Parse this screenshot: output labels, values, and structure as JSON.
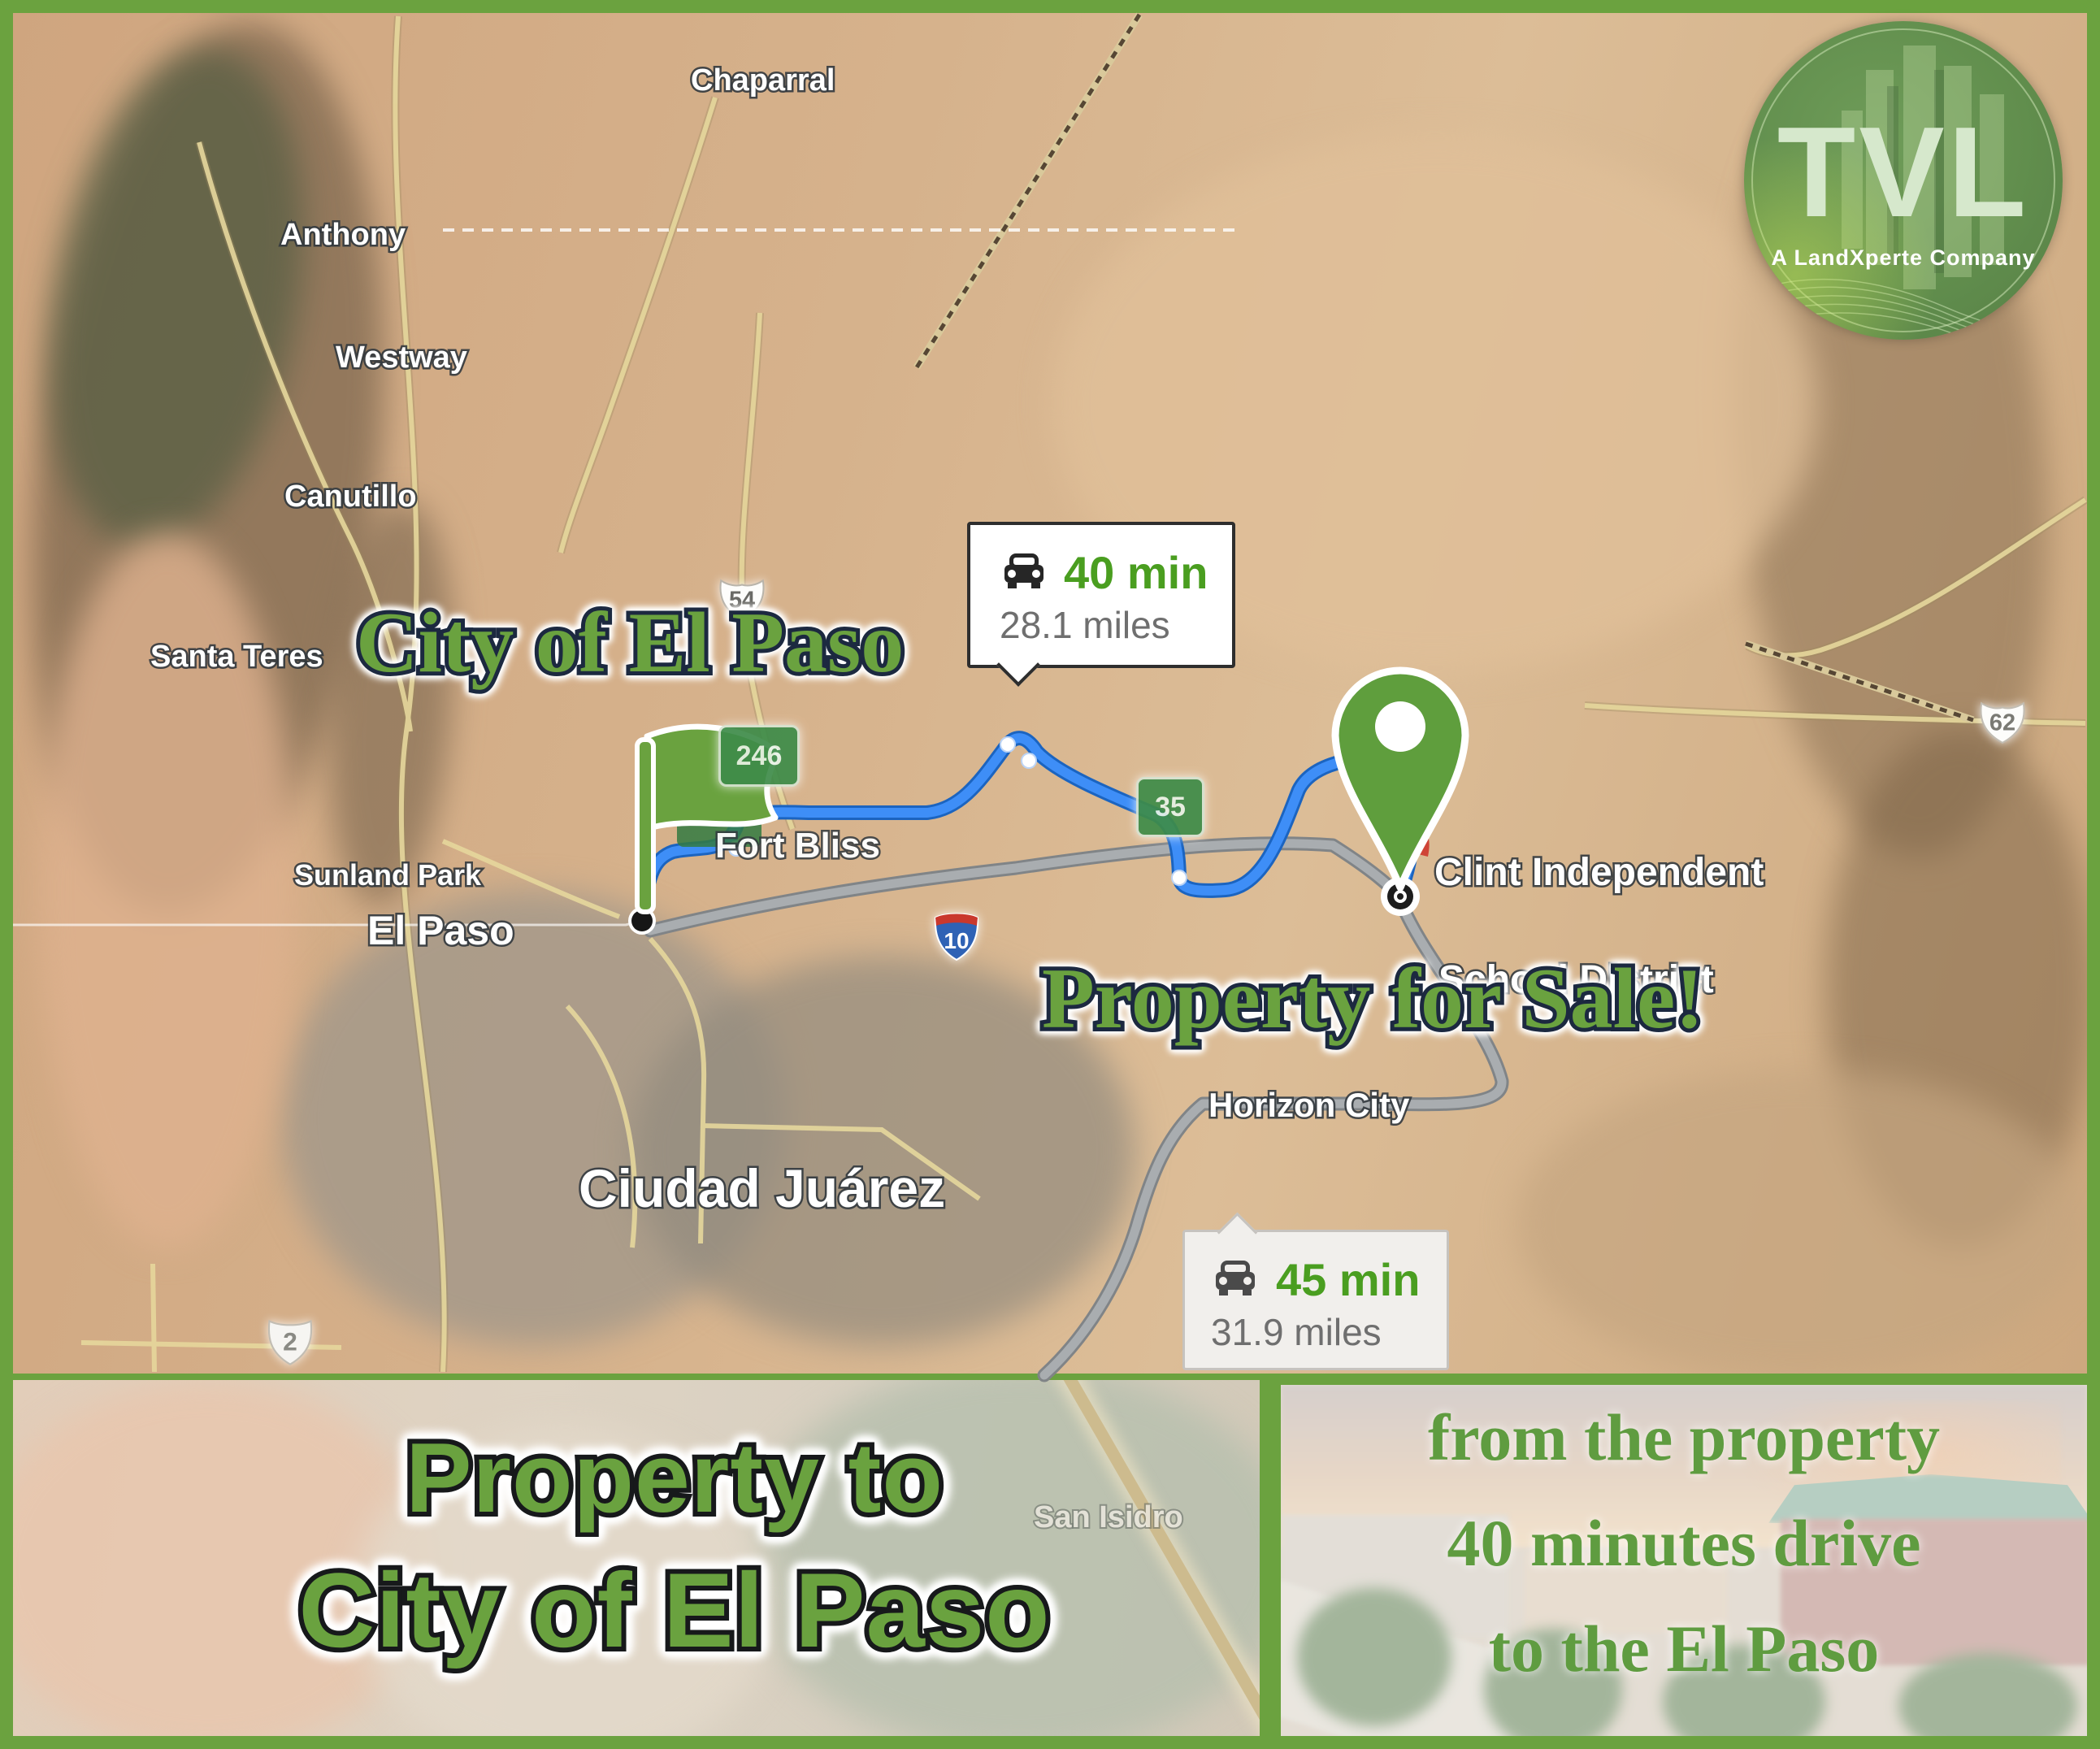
{
  "brand": {
    "logo_text": "TVL",
    "logo_tagline": "A LandXperte Company"
  },
  "map_titles": {
    "city_overlay": "City of El Paso",
    "sale_overlay": "Property for Sale!"
  },
  "route_badges": {
    "fast": {
      "time": "40 min",
      "distance": "28.1 miles"
    },
    "alt": {
      "time": "45 min",
      "distance": "31.9 miles"
    }
  },
  "place_labels": {
    "chaparral": "Chaparral",
    "anthony": "Anthony",
    "westway": "Westway",
    "canutillo": "Canutillo",
    "santa_teresa": "Santa Teres",
    "sunland_park": "Sunland Park",
    "fort_bliss": "Fort Bliss",
    "el_paso": "El Paso",
    "ciudad_juarez": "Ciudad Juárez",
    "horizon_city": "Horizon City",
    "san_isidro": "San Isidro",
    "clint_line1": "Clint Independent",
    "clint_line2": "School District"
  },
  "highway_shields": {
    "us54": "54",
    "nm246": "246",
    "nm35": "35",
    "i10": "10",
    "us62": "62",
    "mx2": "2"
  },
  "bottom_left_caption": {
    "line1": "Property to",
    "line2": "City of El Paso"
  },
  "bottom_right_caption": {
    "line1": "from the property",
    "line2": "40 minutes drive",
    "line3": "to the El Paso"
  },
  "colors": {
    "accent_green": "#6ba23f",
    "headline_green": "#6aa23f",
    "badge_time_green": "#4a9e20",
    "route_blue": "#3e8ef7",
    "route_gray": "#a9adb0"
  }
}
